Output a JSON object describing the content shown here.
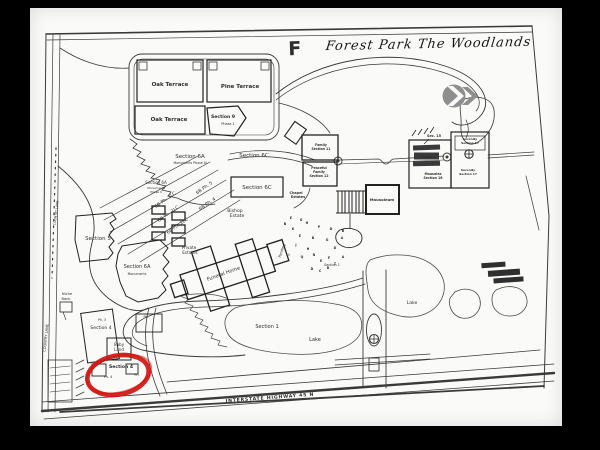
{
  "page": {
    "background": "#fafaf9",
    "frame_color": "#000000",
    "ink_color": "#2e2e2e"
  },
  "annotations": {
    "marker": "F",
    "title": "Forest Park The Woodlands",
    "highlight_color": "#cf1510"
  },
  "logo": {
    "name": "forest-park-arrow-logo",
    "color": "#8e8e8e"
  },
  "map": {
    "labels": [
      {
        "n": "oak-terrace-1",
        "t": "Oak Terrace",
        "x": 140,
        "y": 78,
        "s": 5.5,
        "b": 1
      },
      {
        "n": "pine-terrace",
        "t": "Pine Terrace",
        "x": 210,
        "y": 80,
        "s": 5.5,
        "b": 1
      },
      {
        "n": "oak-terrace-2",
        "t": "Oak Terrace",
        "x": 139,
        "y": 113,
        "s": 5.5,
        "b": 1
      },
      {
        "n": "section-9",
        "t": "Section 9",
        "x": 193,
        "y": 110,
        "s": 4.6,
        "b": 1
      },
      {
        "n": "section-9-phase-1",
        "t": "Phase 1",
        "x": 198,
        "y": 117,
        "s": 3.4
      },
      {
        "n": "section-6a-phase3",
        "t": "Section 6A",
        "x": 160,
        "y": 150,
        "s": 5.5
      },
      {
        "n": "section-6a-phase3-sub",
        "t": "Monuments Phase III",
        "x": 160,
        "y": 156,
        "s": 3.2
      },
      {
        "n": "section-6c-strip",
        "t": "Section 6C",
        "x": 224,
        "y": 149,
        "s": 5.5
      },
      {
        "n": "section-6a-phase2",
        "t": "Section 6A",
        "x": 126,
        "y": 176,
        "s": 4
      },
      {
        "n": "section-6a-phase2-sub1",
        "t": "Monuments",
        "x": 126,
        "y": 181,
        "s": 3
      },
      {
        "n": "section-6a-phase2-sub2",
        "t": "Phase II",
        "x": 126,
        "y": 185,
        "s": 3
      },
      {
        "n": "6b-ph-5",
        "t": "6B Ph. 5",
        "x": 175,
        "y": 181,
        "s": 4.6,
        "r": -35
      },
      {
        "n": "6b-ph-3lc",
        "t": "6B Ph. 3LC",
        "x": 136,
        "y": 193,
        "s": 4.6,
        "r": -35
      },
      {
        "n": "6b-ph-4",
        "t": "6B Ph. 4",
        "x": 178,
        "y": 197,
        "s": 4.6,
        "r": -35
      },
      {
        "n": "section-6c-box",
        "t": "Section 6C",
        "x": 227,
        "y": 181,
        "s": 5.5
      },
      {
        "n": "6b-ph-2lc",
        "t": "6B Ph. 2LC",
        "x": 139,
        "y": 207,
        "s": 4.6,
        "r": -35
      },
      {
        "n": "6b-ph-1lc",
        "t": "6B Ph. 1LC",
        "x": 148,
        "y": 219,
        "s": 4.6,
        "r": -35
      },
      {
        "n": "bishop-estate-line1",
        "t": "Bishop",
        "x": 205,
        "y": 204,
        "s": 4.6
      },
      {
        "n": "bishop-estate-line2",
        "t": "Estate",
        "x": 207,
        "y": 209,
        "s": 4.6
      },
      {
        "n": "section-5",
        "t": "Section 5",
        "x": 68,
        "y": 232,
        "s": 5.5
      },
      {
        "n": "section-6a-monuments",
        "t": "Section 6A",
        "x": 107,
        "y": 260,
        "s": 5
      },
      {
        "n": "section-6a-monuments-sub",
        "t": "Monuments",
        "x": 107,
        "y": 267,
        "s": 3.2
      },
      {
        "n": "private-estates-line1",
        "t": "Private",
        "x": 159,
        "y": 241,
        "s": 4.2
      },
      {
        "n": "private-estates-line2",
        "t": "Estates",
        "x": 160,
        "y": 246,
        "s": 4.2
      },
      {
        "n": "funeral-home",
        "t": "Funeral Home",
        "x": 194,
        "y": 267,
        "s": 5,
        "r": -20
      },
      {
        "n": "pending",
        "t": "Pending",
        "x": 253,
        "y": 243,
        "s": 3.6,
        "r": -72
      },
      {
        "n": "niche-bank-line1",
        "t": "Niche",
        "x": 37,
        "y": 287,
        "s": 3.6
      },
      {
        "n": "niche-bank-line2",
        "t": "Bank",
        "x": 36,
        "y": 292,
        "s": 3.6
      },
      {
        "n": "chapel-estates-line1",
        "t": "Chapel",
        "x": 266,
        "y": 186,
        "s": 3.4,
        "b": 1
      },
      {
        "n": "chapel-estates-line2",
        "t": "Estates",
        "x": 268,
        "y": 190,
        "s": 3.4,
        "b": 1
      },
      {
        "n": "family-section-11-line1",
        "t": "Family",
        "x": 291,
        "y": 138,
        "s": 3.2,
        "b": 1
      },
      {
        "n": "family-section-11-line2",
        "t": "Section 11",
        "x": 291,
        "y": 142,
        "s": 3.2,
        "b": 1
      },
      {
        "n": "family-section-12-line1",
        "t": "Peaceful",
        "x": 289,
        "y": 161,
        "s": 3.2,
        "b": 1
      },
      {
        "n": "family-section-12-line2",
        "t": "Family",
        "x": 289,
        "y": 165,
        "s": 3.2,
        "b": 1
      },
      {
        "n": "family-section-12-line3",
        "t": "Section 12",
        "x": 289,
        "y": 169,
        "s": 3.2,
        "b": 1
      },
      {
        "n": "mausoleum",
        "t": "Mausoleum",
        "x": 352,
        "y": 193,
        "s": 3.8,
        "b": 1
      },
      {
        "n": "sec-15",
        "t": "Sec. 15",
        "x": 404,
        "y": 129,
        "s": 3.4,
        "b": 1
      },
      {
        "n": "plaza",
        "t": "Plaza",
        "x": 396,
        "y": 150,
        "s": 3.6,
        "b": 1,
        "c": "#ffffff"
      },
      {
        "n": "mausolea-16-line1",
        "t": "Mausolea",
        "x": 403,
        "y": 167,
        "s": 3.2,
        "b": 1
      },
      {
        "n": "mausolea-16-line2",
        "t": "Section 16",
        "x": 403,
        "y": 171,
        "s": 3.2,
        "b": 1
      },
      {
        "n": "serenity-17-top-line1",
        "t": "Serenity",
        "x": 440,
        "y": 132,
        "s": 3,
        "b": 1
      },
      {
        "n": "serenity-17-top-line2",
        "t": "Section 17",
        "x": 440,
        "y": 136,
        "s": 3,
        "b": 1
      },
      {
        "n": "serenity-17-bot-line1",
        "t": "Serenity",
        "x": 438,
        "y": 163,
        "s": 3,
        "b": 1
      },
      {
        "n": "serenity-17-bot-line2",
        "t": "Section 17",
        "x": 438,
        "y": 167,
        "s": 3,
        "b": 1
      },
      {
        "n": "section-1-garden",
        "t": "Section 1",
        "x": 302,
        "y": 258,
        "s": 3.4
      },
      {
        "n": "section-1",
        "t": "Section 1",
        "x": 237,
        "y": 320,
        "s": 5
      },
      {
        "n": "lake-1",
        "t": "Lake",
        "x": 285,
        "y": 333,
        "s": 5
      },
      {
        "n": "lake-2",
        "t": "Lake",
        "x": 382,
        "y": 296,
        "s": 4.6
      },
      {
        "n": "ph-3",
        "t": "Ph. 3",
        "x": 72,
        "y": 313,
        "s": 3.2
      },
      {
        "n": "section-4-upper",
        "t": "Section 4",
        "x": 71,
        "y": 321,
        "s": 4.6
      },
      {
        "n": "ph-upper-right",
        "t": "Ph.",
        "x": 116,
        "y": 310,
        "s": 3.2
      },
      {
        "n": "baby-land-line1",
        "t": "Baby",
        "x": 89,
        "y": 338,
        "s": 4
      },
      {
        "n": "baby-land-line2",
        "t": "Land",
        "x": 89,
        "y": 343,
        "s": 4
      },
      {
        "n": "section-4-circled",
        "t": "Section 4",
        "x": 91,
        "y": 360,
        "s": 4.6,
        "b": 1
      },
      {
        "n": "ph-4",
        "t": "Ph. 4",
        "x": 78,
        "y": 370,
        "s": 3.4
      },
      {
        "n": "ph-circled-right",
        "t": "Ph.",
        "x": 107,
        "y": 368,
        "s": 3.4
      },
      {
        "n": "country-lane-upper",
        "t": "COUNTRY LANE",
        "x": 27,
        "y": 205,
        "s": 3.2,
        "r": -83
      },
      {
        "n": "country-lane-lower",
        "t": "COUNTRY LANE",
        "x": 17,
        "y": 330,
        "s": 3.6,
        "r": -84
      },
      {
        "n": "interstate-highway",
        "t": "INTERSTATE HIGHWAY 45 N",
        "x": 240,
        "y": 391,
        "s": 4.6,
        "r": -4.3,
        "b": 1,
        "ls": 0.8
      }
    ],
    "plot_letters": [
      {
        "t": "E",
        "x": 261,
        "y": 211
      },
      {
        "t": "B",
        "x": 255,
        "y": 217
      },
      {
        "t": "G",
        "x": 271,
        "y": 213
      },
      {
        "t": "K",
        "x": 263,
        "y": 222
      },
      {
        "t": "H",
        "x": 277,
        "y": 216
      },
      {
        "t": "P",
        "x": 289,
        "y": 220
      },
      {
        "t": "D",
        "x": 301,
        "y": 222
      },
      {
        "t": "B",
        "x": 313,
        "y": 224
      },
      {
        "t": "E",
        "x": 270,
        "y": 229
      },
      {
        "t": "B",
        "x": 283,
        "y": 231
      },
      {
        "t": "G",
        "x": 297,
        "y": 233
      },
      {
        "t": "A",
        "x": 312,
        "y": 231
      },
      {
        "t": "J",
        "x": 266,
        "y": 238
      },
      {
        "t": "H",
        "x": 278,
        "y": 242
      },
      {
        "t": "D",
        "x": 305,
        "y": 241
      },
      {
        "t": "I",
        "x": 259,
        "y": 248
      },
      {
        "t": "Q",
        "x": 272,
        "y": 250
      },
      {
        "t": "N",
        "x": 284,
        "y": 248
      },
      {
        "t": "E",
        "x": 291,
        "y": 254
      },
      {
        "t": "F",
        "x": 299,
        "y": 251
      },
      {
        "t": "A",
        "x": 313,
        "y": 250
      },
      {
        "t": "T",
        "x": 305,
        "y": 257
      },
      {
        "t": "D",
        "x": 282,
        "y": 262
      },
      {
        "t": "C",
        "x": 290,
        "y": 264
      },
      {
        "t": "B",
        "x": 298,
        "y": 261
      }
    ]
  }
}
